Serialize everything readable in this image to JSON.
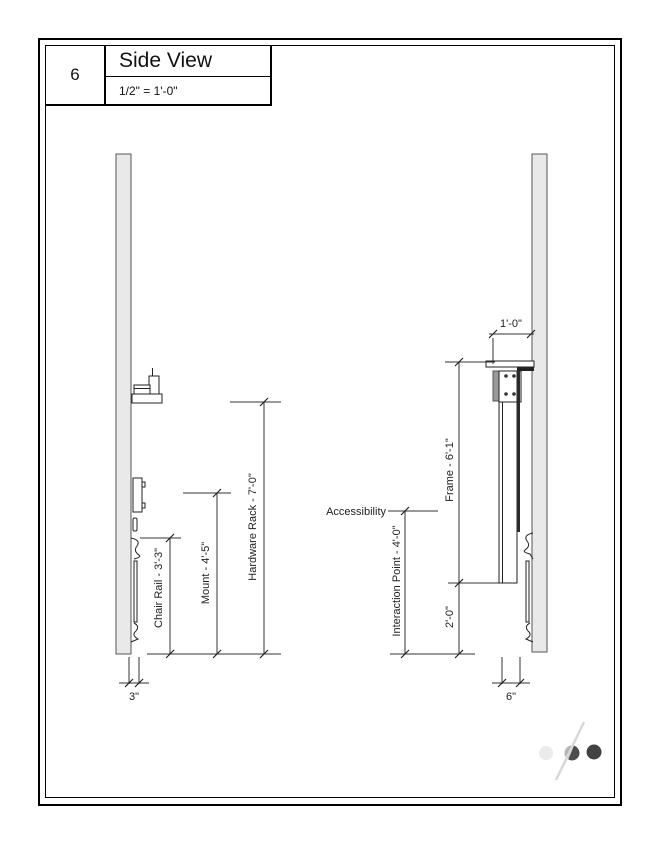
{
  "title_block": {
    "view_number": "6",
    "view_title": "Side View",
    "scale": "1/2\" = 1'-0\""
  },
  "left_view": {
    "dim_chair_rail": "Chair Rail - 3'-3\"",
    "dim_mount": "Mount - 4'-5\"",
    "dim_hardware_rack": "Hardware Rack - 7'-0\"",
    "dim_wall_offset": "3\""
  },
  "right_view": {
    "label_accessibility": "Accessibility",
    "dim_shelf_depth": "1'-0\"",
    "dim_frame": "Frame - 6'-1\"",
    "dim_lower": "2'-0\"",
    "dim_interaction_point": "Interaction Point - 4'-0\"",
    "dim_frame_width": "6\""
  },
  "drawing": {
    "wall_fill": "#e9e9e9",
    "line_color": "#222222"
  },
  "logo": {
    "dot_light": "#ebebeb",
    "dot_mid_light": "#b5b5b5",
    "dot_mid_dark": "#4c4c4c",
    "dot_dark": "#424242",
    "slash": "#d8d8d8"
  }
}
